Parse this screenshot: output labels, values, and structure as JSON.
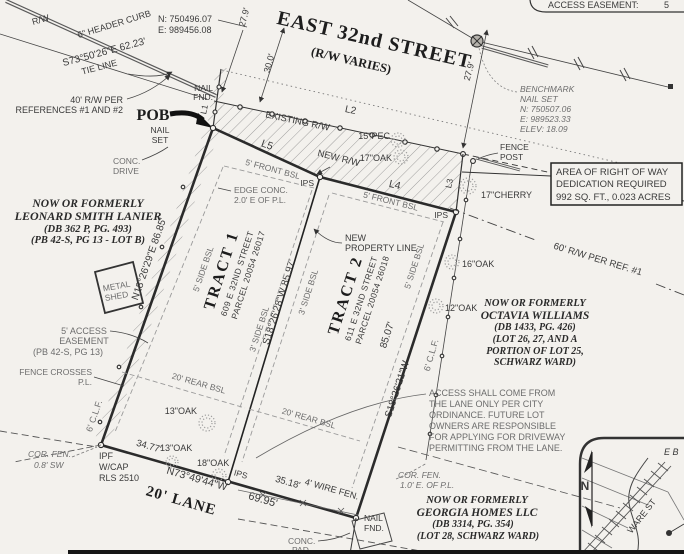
{
  "street": {
    "name": "EAST 32nd STREET",
    "varies": "(R/W VARIES)",
    "curb": "6\" HEADER CURB",
    "rw": "R/W",
    "tie_bearing": "S73°50'26\"E  62.23'",
    "tie_line": "TIE LINE",
    "rw40_line1": "40' R/W PER",
    "rw40_line2": "REFERENCES #1 AND #2",
    "existing_rw": "EXISTING R/W",
    "new_rw": "NEW R/W",
    "rw60": "60' R/W PER REF. #1",
    "lane": "20' LANE"
  },
  "coords": {
    "n": "N: 750496.07",
    "e": "E: 989456.08"
  },
  "benchmark": [
    "BENCHMARK",
    "NAIL SET",
    "N: 750507.06",
    "E: 989523.33",
    "ELEV: 18.09"
  ],
  "points": {
    "pob": "POB",
    "nail": "NAIL",
    "set": "SET",
    "fnd": "FND.",
    "ips": "IPS",
    "ipf": "IPF",
    "wcap": "W/CAP",
    "rls": "RLS 2510",
    "fence": "FENCE",
    "post": "POST"
  },
  "lines": {
    "l1": "L1",
    "l2": "L2",
    "l3": "L3",
    "l4": "L4",
    "l5": "L5"
  },
  "dims": {
    "d279": "27.9'",
    "d300": "30.0'"
  },
  "tract1": {
    "title": "TRACT 1",
    "address": "609 E 32ND STREET",
    "parcel": "PARCEL 20054 26017"
  },
  "tract2": {
    "title": "TRACT 2",
    "address": "611 E 32ND STREET",
    "parcel": "PARCEL 20054 26018"
  },
  "bearings": {
    "west": "N18°26'29\"E  86.85'",
    "mid": "S18°26'28\"W  85.97'",
    "east_dist": "85.07'",
    "east": "S18°26'21\"W",
    "south": "N73°49'44\"W",
    "south_total": "69.95'",
    "seg1": "34.77'",
    "seg2": "35.18'"
  },
  "bsl": {
    "front5": "5' FRONT BSL",
    "side5": "5' SIDE BSL",
    "side3": "3' SIDE BSL",
    "rear20": "20' REAR BSL"
  },
  "features": {
    "conc": "CONC.",
    "drive": "DRIVE",
    "pad": "PAD",
    "edge1": "EDGE CONC.",
    "edge2": "2.0' E OF P.L.",
    "shed1": "METAL",
    "shed2": "SHED",
    "wire": "4' WIRE FEN.",
    "clf": "6' C.L.F.",
    "fc1": "FENCE CROSSES",
    "fc2": "P.L.",
    "cfsw1": "COR. FEN.",
    "cfsw2": "0.8' SW",
    "cfe1": "COR. FEN.",
    "cfe2": "1.0' E. OF P.L.",
    "npl1": "NEW",
    "npl2": "PROPERTY LINE",
    "ae1": "5' ACCESS",
    "ae2": "EASEMENT",
    "ae3": "(PB 42-S, PG 13)"
  },
  "trees": {
    "pec15": "15\"PEC",
    "oak17": "17\"OAK",
    "cherry17": "17\"CHERRY",
    "oak16": "16\"OAK",
    "oak12": "12\"OAK",
    "oak13": "13\"OAK",
    "oak18": "18\"OAK"
  },
  "adjoiners": {
    "lanier": [
      "NOW OR FORMERLY",
      "LEONARD SMITH LANIER",
      "(DB 362 P, PG. 493)",
      "(PB 42-S, PG 13 - LOT B)"
    ],
    "williams": [
      "NOW OR FORMERLY",
      "OCTAVIA WILLIAMS",
      "(DB 1433, PG. 426)",
      "(LOT 26, 27, AND A",
      "PORTION OF LOT 25,",
      "SCHWARZ WARD)"
    ],
    "georgia": [
      "NOW OR FORMERLY",
      "GEORGIA HOMES LLC",
      "(DB 3314, PG. 354)",
      "(LOT 28, SCHWARZ WARD)"
    ]
  },
  "notes": {
    "access": [
      "ACCESS SHALL COME FROM",
      "THE LANE ONLY PER CITY",
      "ORDINANCE. FUTURE LOT",
      "OWNERS ARE RESPONSIBLE",
      "FOR APPLYING FOR DRIVEWAY",
      "PERMITTING FROM THE LANE."
    ],
    "row_box": [
      "AREA OF RIGHT OF WAY",
      "DEDICATION REQUIRED",
      "992 SQ. FT., 0.023 ACRES"
    ],
    "top_label": "ACCESS EASEMENT:",
    "top_value": "5"
  },
  "inset": {
    "north": "N",
    "ware": "WARE ST",
    "eb": "E B"
  }
}
